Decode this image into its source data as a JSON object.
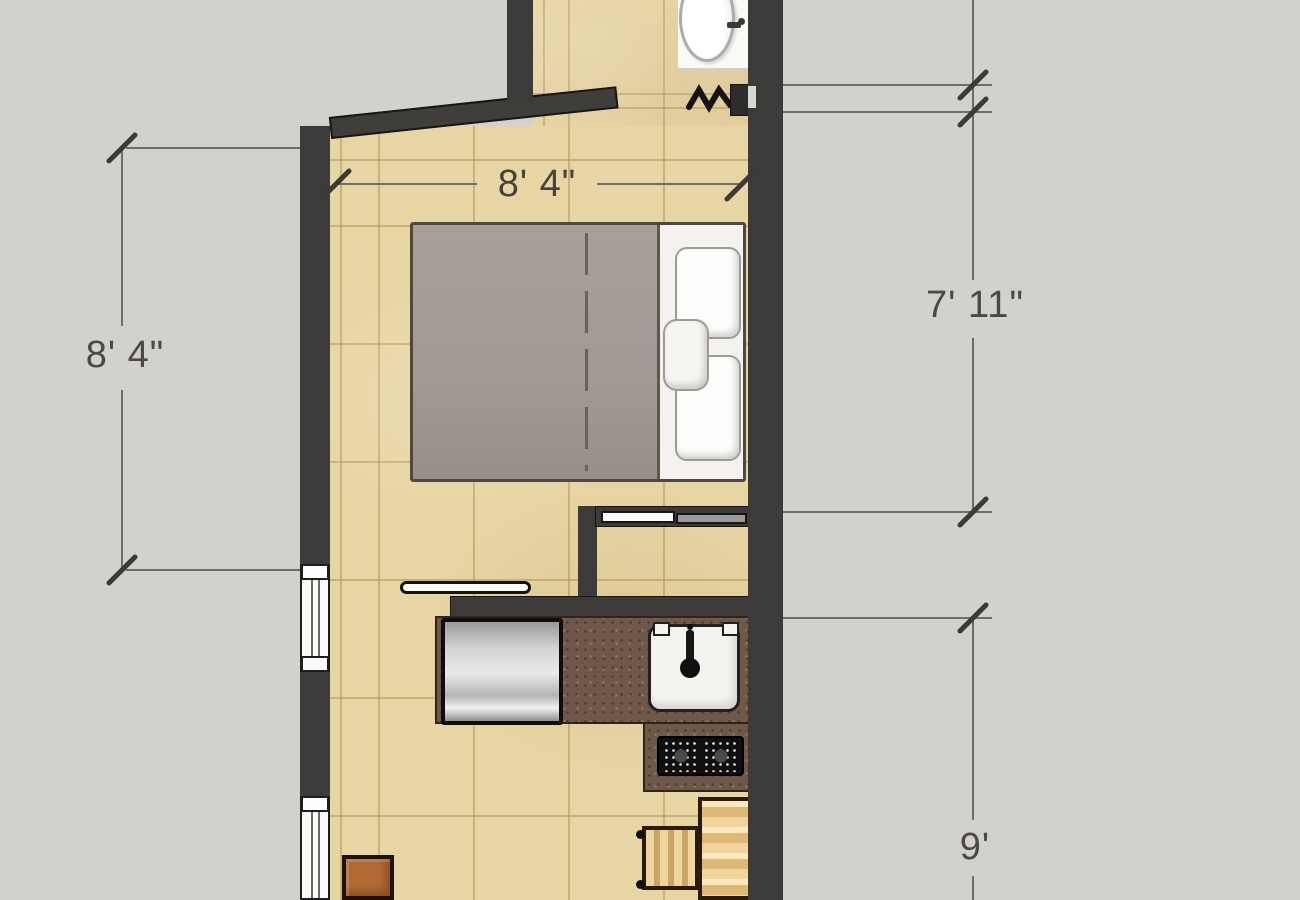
{
  "scene": {
    "type": "apartment-floor-plan-top-view",
    "background_color": "#d1d1ce",
    "wall_color": "#3c3b39",
    "floor_color": "#e8d5a4",
    "counter_color": "#6f5847",
    "dimension_line_color": "#6e6d69",
    "dimension_tick_color": "#3a3a38",
    "dimension_text_color": "#4d4841",
    "bed_duvet_color": "#a29a92",
    "wood_color": "#e5c685",
    "stool_color": "#b26a33"
  },
  "dimensions": {
    "top_width": "8' 4\"",
    "left_height": "8' 4\"",
    "right_upper_height": "7' 11\"",
    "right_lower_height": "9'"
  },
  "furniture": [
    {
      "name": "bathroom-sink",
      "area": "bathroom"
    },
    {
      "name": "towel-radiator",
      "area": "bathroom"
    },
    {
      "name": "entry-door",
      "area": "bedroom"
    },
    {
      "name": "double-bed",
      "area": "bedroom"
    },
    {
      "name": "pillows",
      "area": "bedroom"
    },
    {
      "name": "sliding-door-closet",
      "area": "bedroom"
    },
    {
      "name": "wall-shelf",
      "area": "kitchen"
    },
    {
      "name": "refrigerator",
      "area": "kitchen"
    },
    {
      "name": "kitchen-sink",
      "area": "kitchen"
    },
    {
      "name": "two-burner-cooktop",
      "area": "kitchen"
    },
    {
      "name": "dining-table",
      "area": "dining"
    },
    {
      "name": "dining-chair",
      "area": "dining"
    },
    {
      "name": "stool",
      "area": "dining"
    },
    {
      "name": "window-left-upper",
      "area": "wall"
    },
    {
      "name": "window-left-lower",
      "area": "wall"
    }
  ]
}
